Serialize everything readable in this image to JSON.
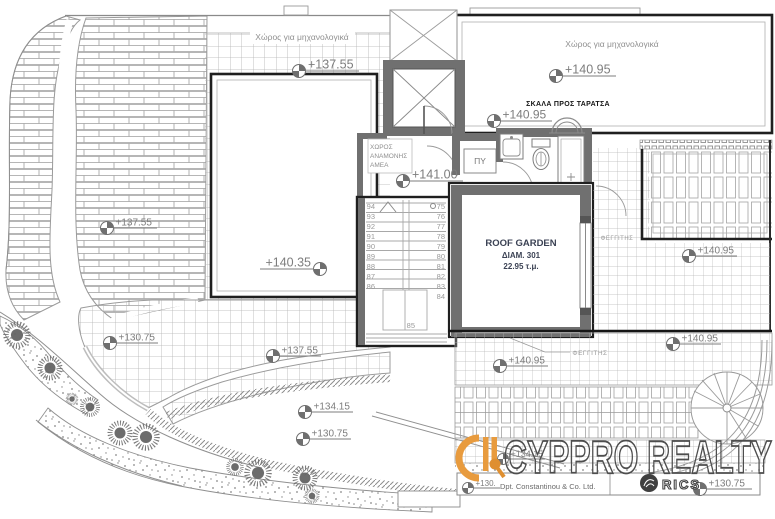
{
  "plan": {
    "labels": {
      "mech_room_left": "Χώρος για μηχανολογικά",
      "mech_room_right": "Χώρος για μηχανολογικά",
      "stair_to_roof": "ΣΚΑΛΑ ΠΡΟΣ ΤΑΡΑΤΣΑ",
      "amea_1": "ΧΩΡΟΣ",
      "amea_2": "ΑΝΑΜΟΝΗΣ",
      "amea_3": "ΑΜΕΑ",
      "py": "ΠΥ",
      "roof_garden_title": "ROOF GARDEN",
      "roof_garden_unit": "ΔΙΑΜ. 301",
      "roof_garden_area": "22.95 τ.μ.",
      "skylight_upper": "ΦΕΓΓΙΤΗΣ",
      "skylight_lower": "ΦΕΓΓΙΤΗΣ"
    },
    "levels": [
      "+137.55",
      "+137.55",
      "+140.35",
      "+140.95",
      "+140.95",
      "+141.00",
      "+137.55",
      "+130.75",
      "+134.15",
      "+130.75",
      "+140.95",
      "+140.95",
      "+140.95",
      "+134.15",
      "+130.",
      "+130.75"
    ],
    "stairs": {
      "left": [
        "94",
        "93",
        "92",
        "91",
        "90",
        "89",
        "88",
        "87",
        "86"
      ],
      "right": [
        "75",
        "76",
        "77",
        "78",
        "79",
        "80",
        "81",
        "82",
        "83",
        "84"
      ],
      "landing": "85"
    },
    "branding": {
      "name": "CYPPRO REALTY",
      "company": "Dpt. Constantinou & Co. Ltd.",
      "rics": "RICS",
      "accent_color": "#E89B3E"
    }
  }
}
